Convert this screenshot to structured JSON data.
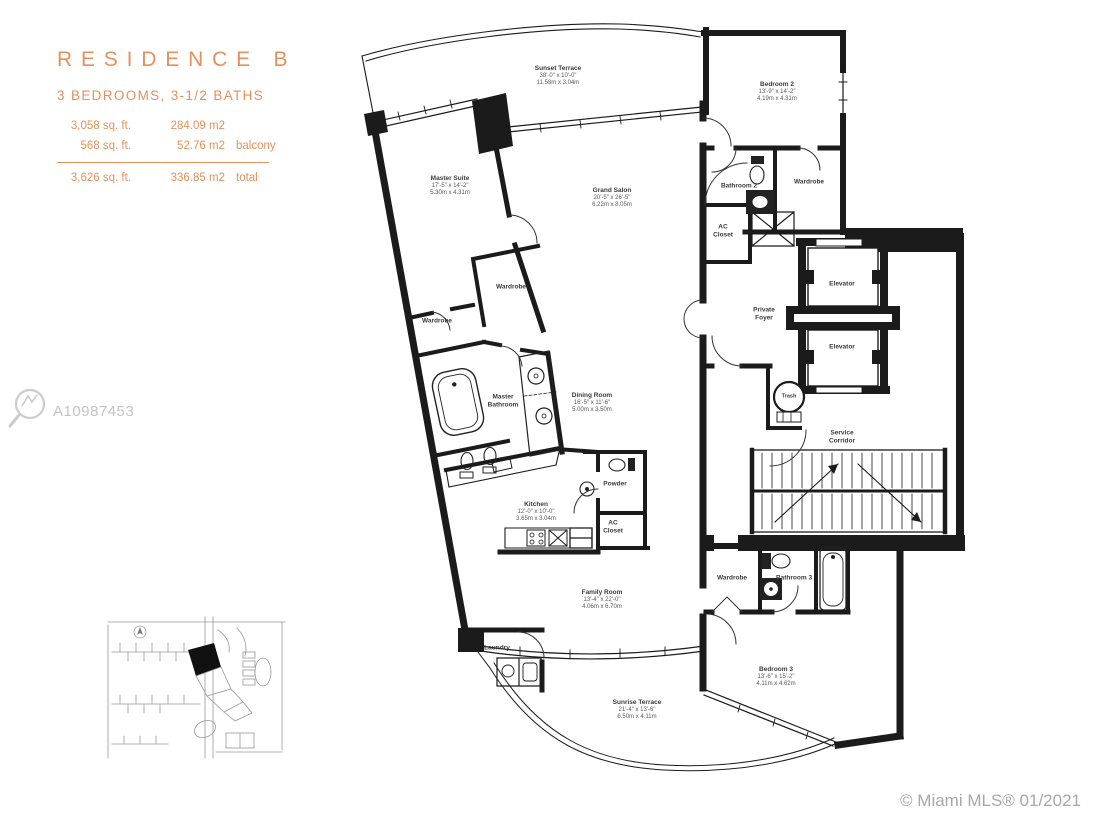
{
  "header": {
    "title": "RESIDENCE B",
    "subtitle": "3 BEDROOMS, 3-1/2 BATHS",
    "areas": [
      {
        "sqft": "3,058 sq. ft.",
        "m2": "284.09 m2",
        "note": ""
      },
      {
        "sqft": "568 sq. ft.",
        "m2": "52.76 m2",
        "note": "balcony"
      }
    ],
    "total": {
      "sqft": "3,626 sq. ft.",
      "m2": "336.85 m2",
      "note": "total"
    }
  },
  "watermark": {
    "id": "A10987453"
  },
  "footer": {
    "credit": "© Miami MLS® 01/2021"
  },
  "colors": {
    "accent": "#E5915C",
    "wall": "#1b1b1b",
    "watermark_gray": "#c3c3c3",
    "credit_gray": "#a8a8a8"
  },
  "rooms": {
    "sunset_terrace": {
      "name": "Sunset Terrace",
      "ft": "38'-0\" x 10'-0\"",
      "m": "11.58m x 3.04m"
    },
    "master_suite": {
      "name": "Master Suite",
      "ft": "17'-5\" x 14'-2\"",
      "m": "5.30m x 4.31m"
    },
    "grand_salon": {
      "name": "Grand Salon",
      "ft": "20'-5\" x 26'-5\"",
      "m": "6.22m x 8.05m"
    },
    "bedroom2": {
      "name": "Bedroom 2",
      "ft": "13'-9\" x 14'-2\"",
      "m": "4.19m x 4.31m"
    },
    "bathroom2": {
      "name": "Bathroom 2"
    },
    "wardrobe_bedroom2": {
      "name": "Wardrobe"
    },
    "ac_closet_foyer": {
      "name": "AC Closet"
    },
    "private_foyer": {
      "name": "Private Foyer"
    },
    "elevator_a": {
      "name": "Elevator"
    },
    "elevator_b": {
      "name": "Elevator"
    },
    "trash": {
      "name": "Trash"
    },
    "service_corridor": {
      "name": "Service Corridor"
    },
    "wardrobe_master_a": {
      "name": "Wardrobe"
    },
    "wardrobe_master_b": {
      "name": "Wardrobe"
    },
    "master_bathroom": {
      "name": "Master Bathroom"
    },
    "dining_room": {
      "name": "Dining Room",
      "ft": "16'-5\" x 11'-6\"",
      "m": "5.00m x 3.50m"
    },
    "powder": {
      "name": "Powder"
    },
    "kitchen": {
      "name": "Kitchen",
      "ft": "12'-0\" x 10'-0\"",
      "m": "3.65m x 3.04m"
    },
    "ac_closet_kitchen": {
      "name": "AC Closet"
    },
    "family_room": {
      "name": "Family Room",
      "ft": "13'-4\" x 22'-0\"",
      "m": "4.06m x 6.70m"
    },
    "wardrobe_bedroom3": {
      "name": "Wardrobe"
    },
    "bathroom3": {
      "name": "Bathroom 3"
    },
    "laundry": {
      "name": "Laundry"
    },
    "bedroom3": {
      "name": "Bedroom 3",
      "ft": "13'-6\" x 15'-2\"",
      "m": "4.11m x 4.62m"
    },
    "sunrise_terrace": {
      "name": "Sunrise Terrace",
      "ft": "21'-4\" x 13'-6\"",
      "m": "6.50m x 4.11m"
    }
  }
}
